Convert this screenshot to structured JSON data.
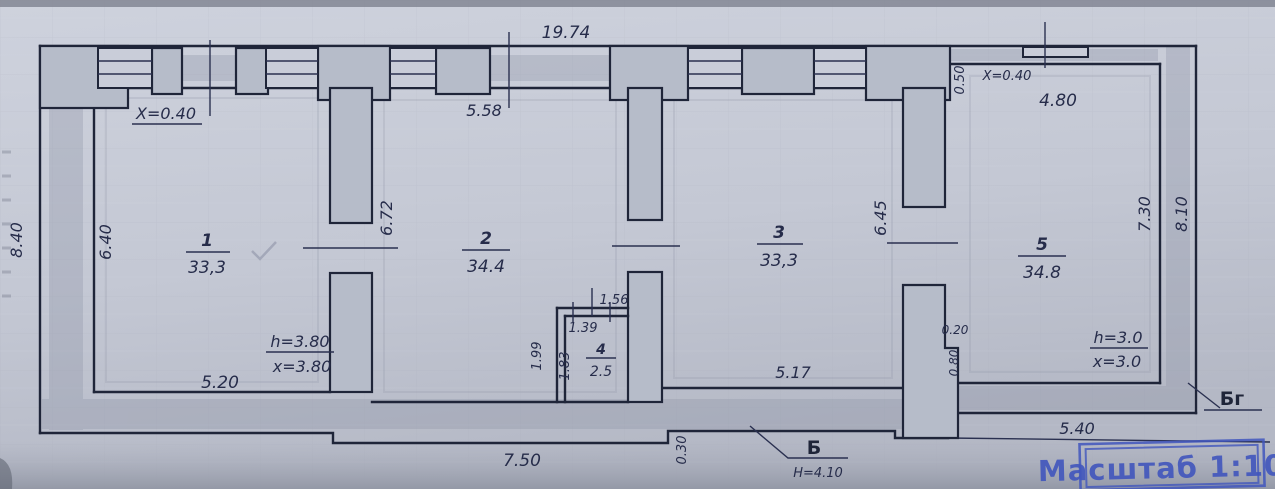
{
  "plan": {
    "stamp": {
      "text": "Масштаб 1:100",
      "color": "#4156bd"
    },
    "rooms": [
      {
        "number": "1",
        "area": "33,3"
      },
      {
        "number": "2",
        "area": "34.4"
      },
      {
        "number": "3",
        "area": "33,3"
      },
      {
        "number": "4",
        "area": "2.5"
      },
      {
        "number": "5",
        "area": "34.8"
      }
    ],
    "dims": {
      "overall_top": "19.74",
      "left_outer": "8.40",
      "room1_height": "6.40",
      "room1_width": "5.20",
      "room1_wall_offset": "X=0.40",
      "room1_ceiling": "h=3.80",
      "room1_x": "x=3.80",
      "room2_top": "5.58",
      "room2_height": "6.72",
      "room3_width": "5.17",
      "room3_height": "6.45",
      "room4_top": "1.56",
      "room4_inner_width": "1.39",
      "room4_left": "1.99",
      "room4_inner_height": "1.83",
      "room5_offset": "0.50",
      "room5_wall_offset": "X=0.40",
      "room5_top": "4.80",
      "room5_height_inner": "7.30",
      "right_outer": "8.10",
      "room5_ceiling": "h=3.0",
      "room5_x": "x=3.0",
      "step_small": "0.20",
      "step_large": "0.80",
      "bottom_left": "7.50",
      "bottom_step": "0.30",
      "bottom_right": "5.40"
    },
    "markers": {
      "b_label": "Б",
      "b_height": "H=4.10",
      "bg_label": "Бг"
    }
  }
}
